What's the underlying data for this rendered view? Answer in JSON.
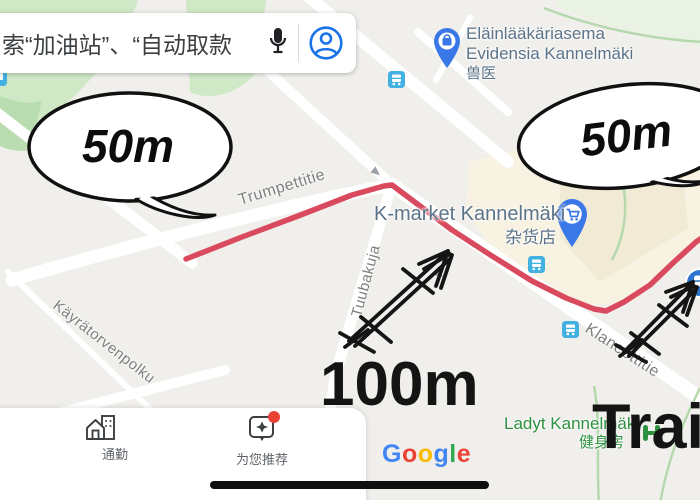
{
  "search": {
    "placeholder": "索“加油站”、“自动取款"
  },
  "map": {
    "streets": {
      "trumpettitie": "Trumpettitie",
      "tuubakuja": "Tuubakuja",
      "kayratorvenpolku": "Käyrätorvenpolku",
      "klaneettitie": "Klaneettitie"
    },
    "pois": {
      "vet": {
        "line1": "Eläinlääkäriasema",
        "line2": "Evidensia Kannelmäki",
        "cn": "兽医"
      },
      "kmarket": {
        "name": "K-market Kannelmäki",
        "cn": "杂货店"
      },
      "ladyt": {
        "name": "Ladyt Kannelmäki",
        "cn": "健身房"
      }
    }
  },
  "annotations": {
    "bubble_left": "50m",
    "bubble_right": "50m",
    "distance": "100m",
    "train": "Trai"
  },
  "nav": {
    "commute": "通勤",
    "recommended": "为您推荐"
  },
  "google": {
    "l1": "G",
    "l2": "o",
    "l3": "o",
    "l4": "g",
    "l5": "l",
    "l6": "e"
  },
  "colors": {
    "route_red": "#d94a5e",
    "pin_blue": "#3b78e7",
    "transit_blue": "#41b1e1",
    "station_blue": "#2e75cf",
    "poi_green": "#2e9140",
    "poi_blue_gray": "#5b7389",
    "accent_blue": "#1a73e8",
    "badge_red": "#ea4335",
    "map_beige": "#f7f2e1",
    "map_green": "#cfe8c6"
  }
}
